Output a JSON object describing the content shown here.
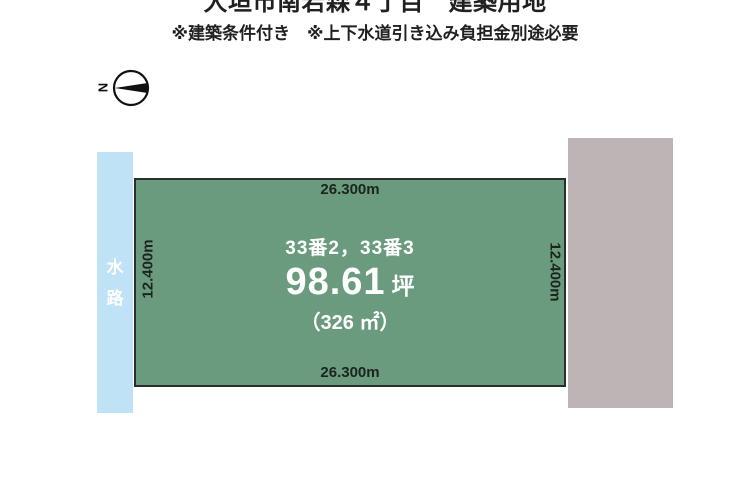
{
  "header": {
    "title": "大垣市南若森４丁目　建築用地",
    "subtitle": "※建築条件付き　※上下水道引き込み負担金別途必要"
  },
  "compass": {
    "north_label": "N"
  },
  "waterway": {
    "char_top": "水",
    "char_bottom": "路"
  },
  "plot": {
    "lot_numbers": "33番2，33番3",
    "area_tsubo": "98.61",
    "tsubo_unit": "坪",
    "area_sqm": "（326 ㎡）",
    "dimensions": {
      "top": "26.300m",
      "bottom": "26.300m",
      "left": "12.400m",
      "right": "12.400m"
    }
  },
  "colors": {
    "plot_fill": "#6b9b7f",
    "plot_border": "#2a2f2b",
    "waterway_fill": "#bfe2f6",
    "building_fill": "#bdb5b5",
    "dim_text": "#1c241e",
    "center_text": "#ffffff"
  }
}
